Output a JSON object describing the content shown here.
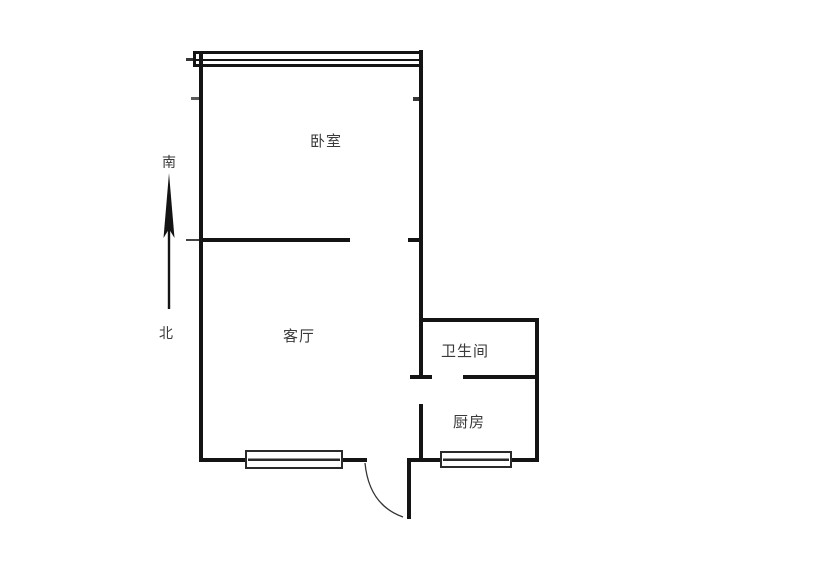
{
  "document": {
    "type": "floor-plan",
    "background": "#ffffff"
  },
  "colors": {
    "line": "#141414",
    "window_stroke": "#2a2a2a",
    "label": "#3a3a3a",
    "arc": "#333333"
  },
  "compass": {
    "south_label": "南",
    "north_label": "北"
  },
  "rooms": [
    {
      "id": "bedroom",
      "label": "卧室"
    },
    {
      "id": "living-room",
      "label": "客厅"
    },
    {
      "id": "bathroom",
      "label": "卫生间"
    },
    {
      "id": "kitchen",
      "label": "厨房"
    }
  ]
}
